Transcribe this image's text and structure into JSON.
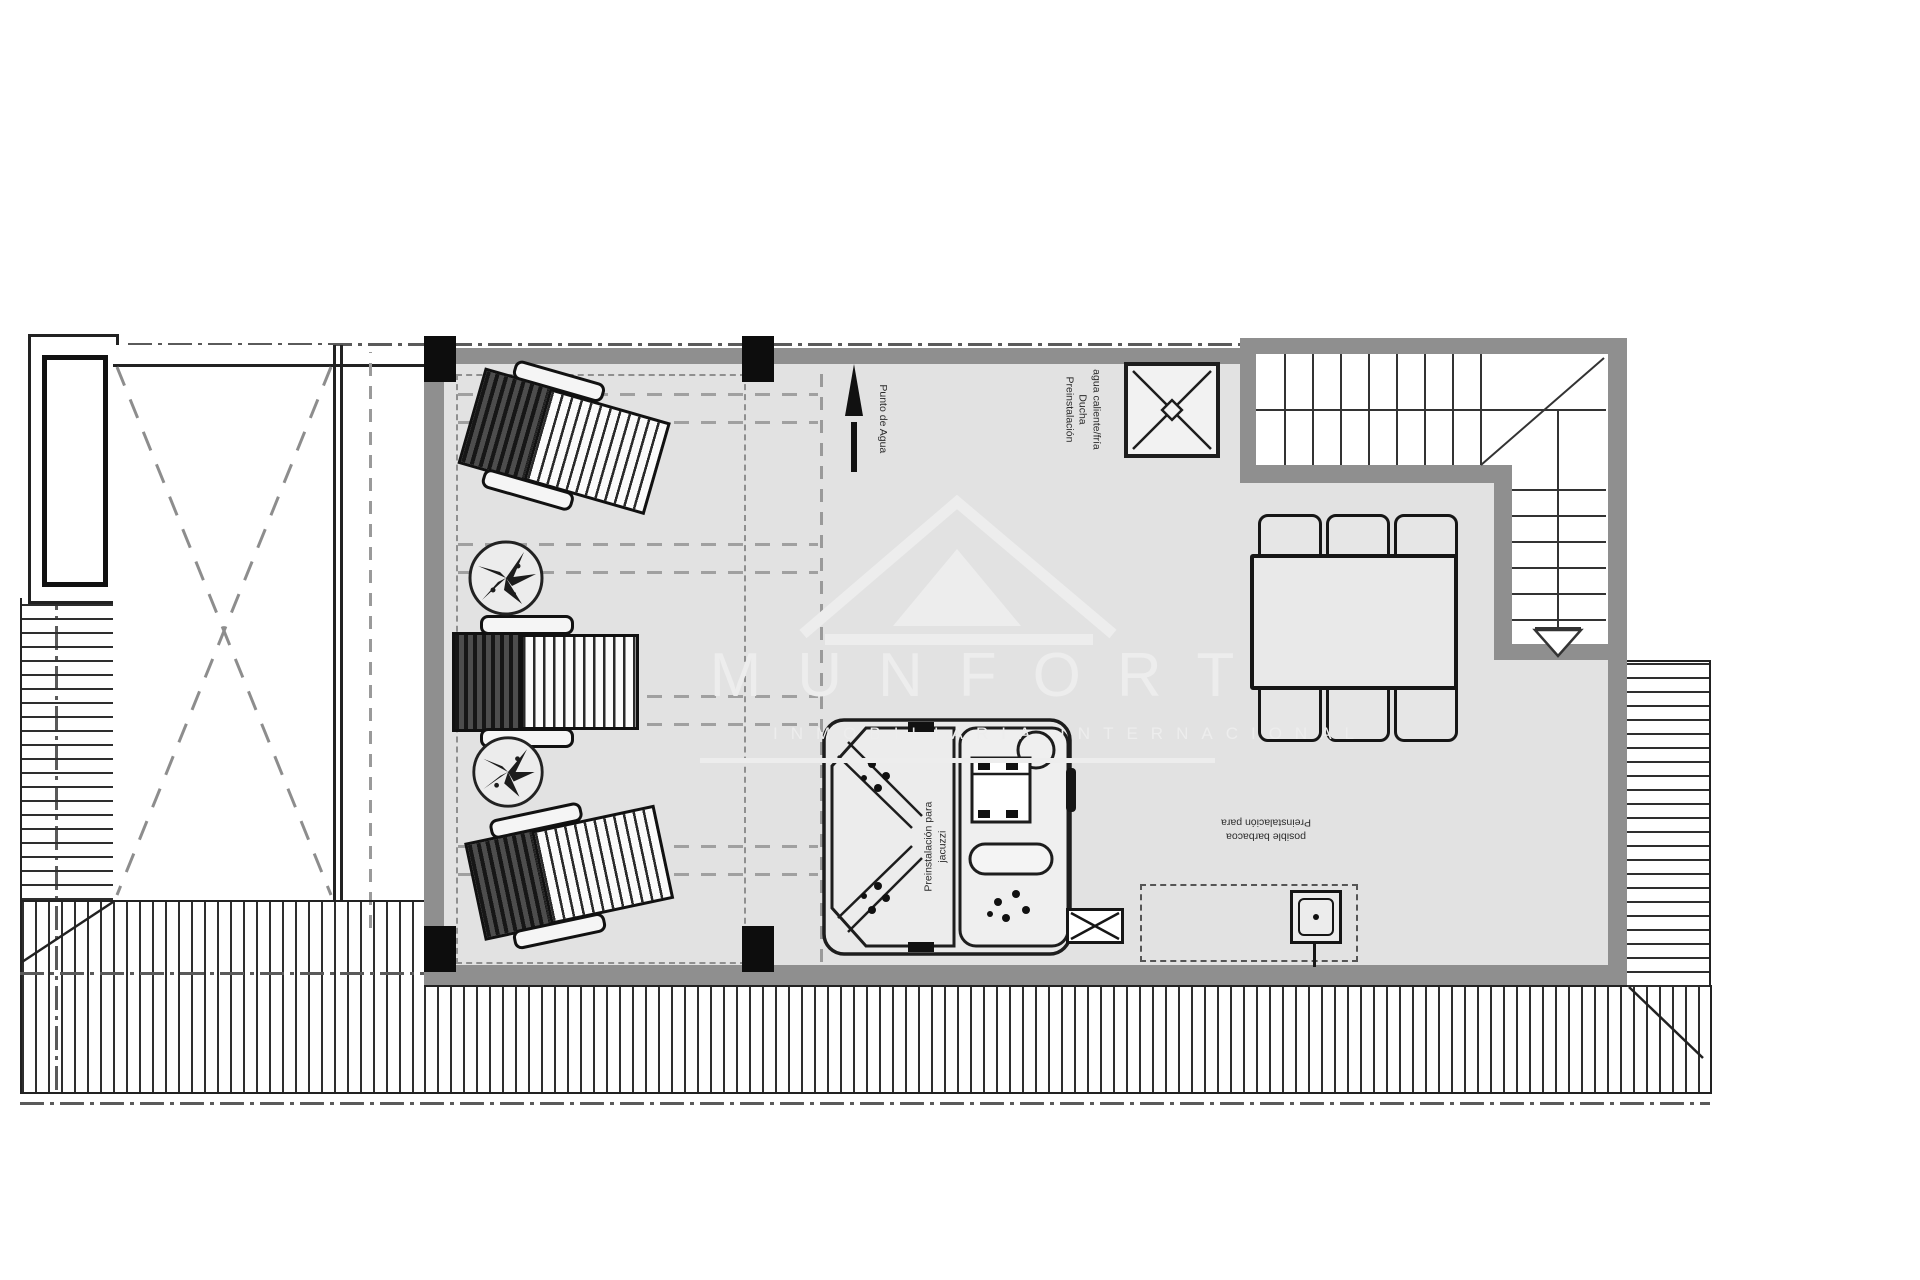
{
  "watermark": {
    "title": "MUNFORT",
    "subtitle": "INMOBILIARIA INTERNACIONAL",
    "logo": "triangle-roof-logo"
  },
  "annotations": {
    "water_point": {
      "label": "Punto de Agua"
    },
    "shower": {
      "lines": [
        "agua caliente/fría",
        "Ducha",
        "Preinstalación"
      ]
    },
    "jacuzzi": {
      "lines": [
        "Preinstalación para",
        "jacuzzi"
      ]
    },
    "barbecue": {
      "lines": [
        "posible barbacoa",
        "Preinstalación para"
      ]
    }
  },
  "colors": {
    "floor": "#e2e2e2",
    "wall": "#8f8f8f",
    "ink": "#1d1d1d",
    "dash": "#9a9a9a",
    "column": "#0d0d0d",
    "watermark": "#ededed"
  }
}
